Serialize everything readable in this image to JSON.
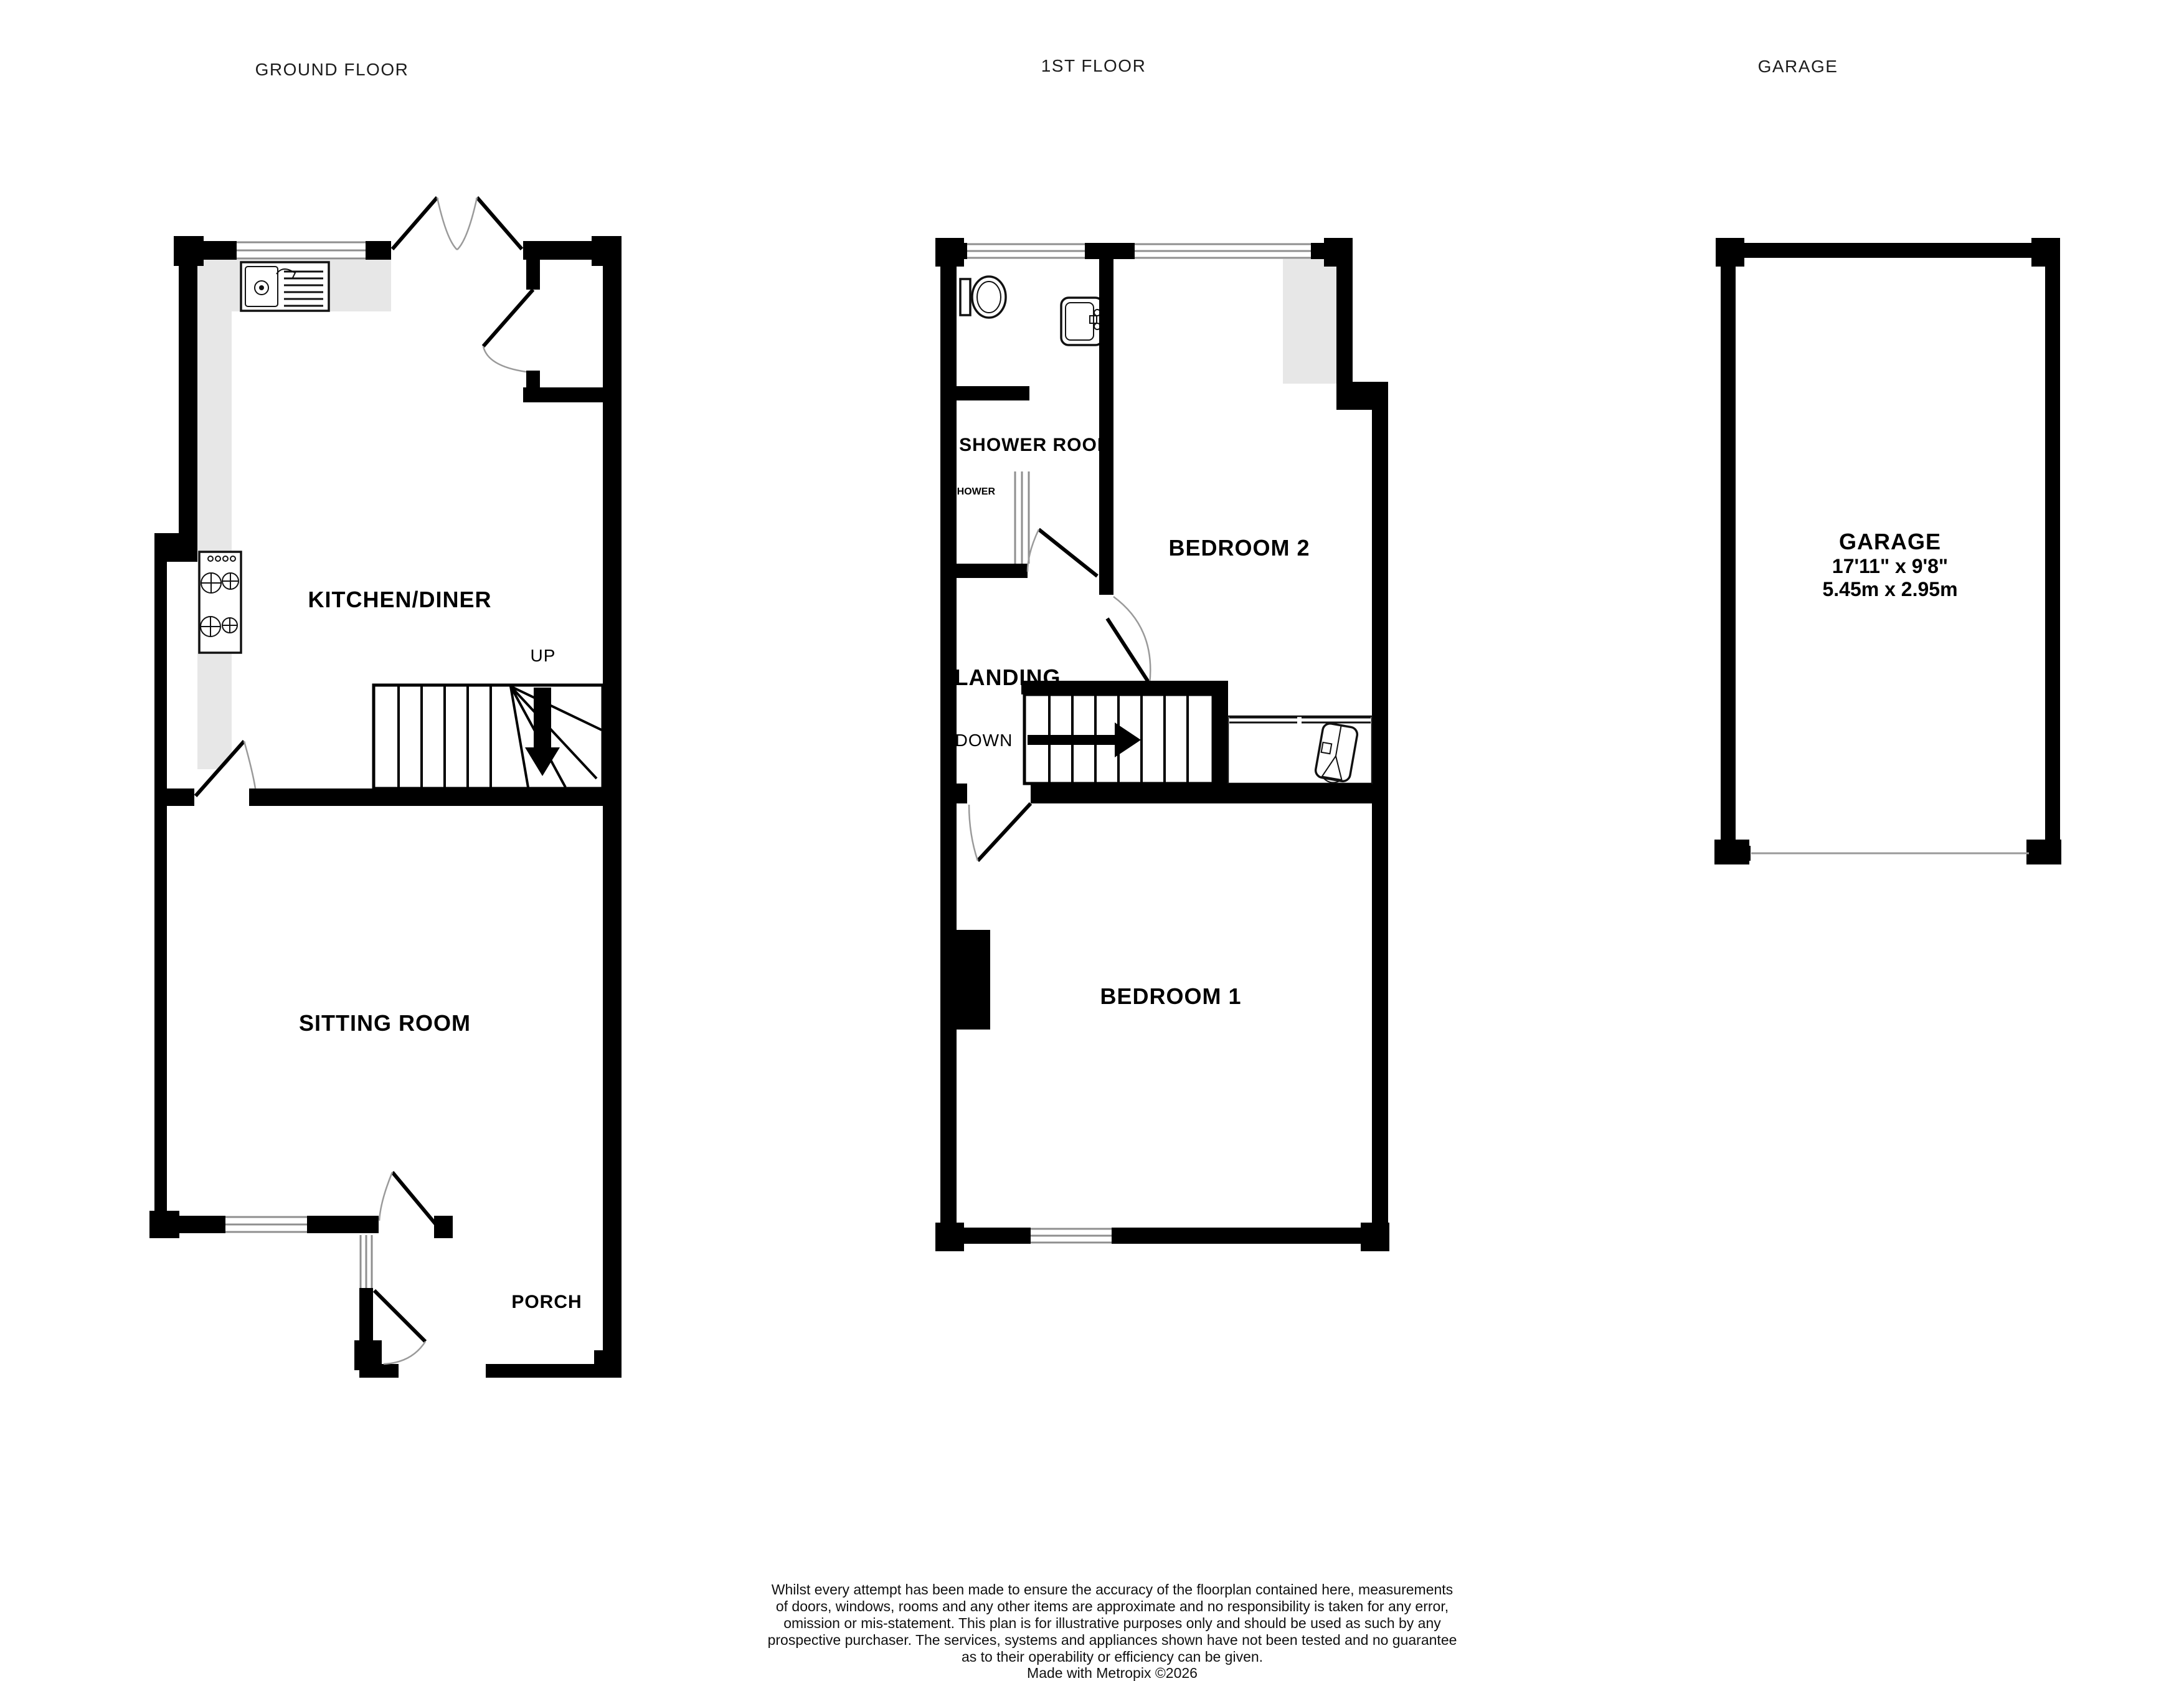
{
  "titles": {
    "ground": "GROUND FLOOR",
    "first": "1ST FLOOR",
    "garage": "GARAGE"
  },
  "ground_floor": {
    "kitchen_label": "KITCHEN/DINER",
    "sitting_label": "SITTING ROOM",
    "porch_label": "PORCH",
    "stairs_label": "UP"
  },
  "first_floor": {
    "shower_room_label": "SHOWER ROOM",
    "shower_label": "SHOWER",
    "bedroom2_label": "BEDROOM 2",
    "landing_label": "LANDING",
    "stairs_label": "DOWN",
    "bedroom1_label": "BEDROOM 1"
  },
  "garage": {
    "label": "GARAGE",
    "size_imperial": "17'11\" x 9'8\"",
    "size_metric": "5.45m x 2.95m"
  },
  "footer": {
    "line1": "Whilst every attempt has been made to ensure the accuracy of the floorplan contained here, measurements",
    "line2": "of doors, windows, rooms and any other items are approximate and no responsibility is taken for any error,",
    "line3": "omission or mis-statement. This plan is for illustrative purposes only and should be used as such by any",
    "line4": "prospective purchaser. The services, systems and appliances shown have not been tested and no guarantee",
    "line5": "as to their operability or efficiency can be given.",
    "line6": "Made with Metropix ©2026"
  },
  "colors": {
    "wall": "#000000",
    "counter_fill": "#e7e7e7",
    "window_line": "#8f8f8f",
    "door_arc": "#9a9a9a",
    "background": "#ffffff"
  }
}
